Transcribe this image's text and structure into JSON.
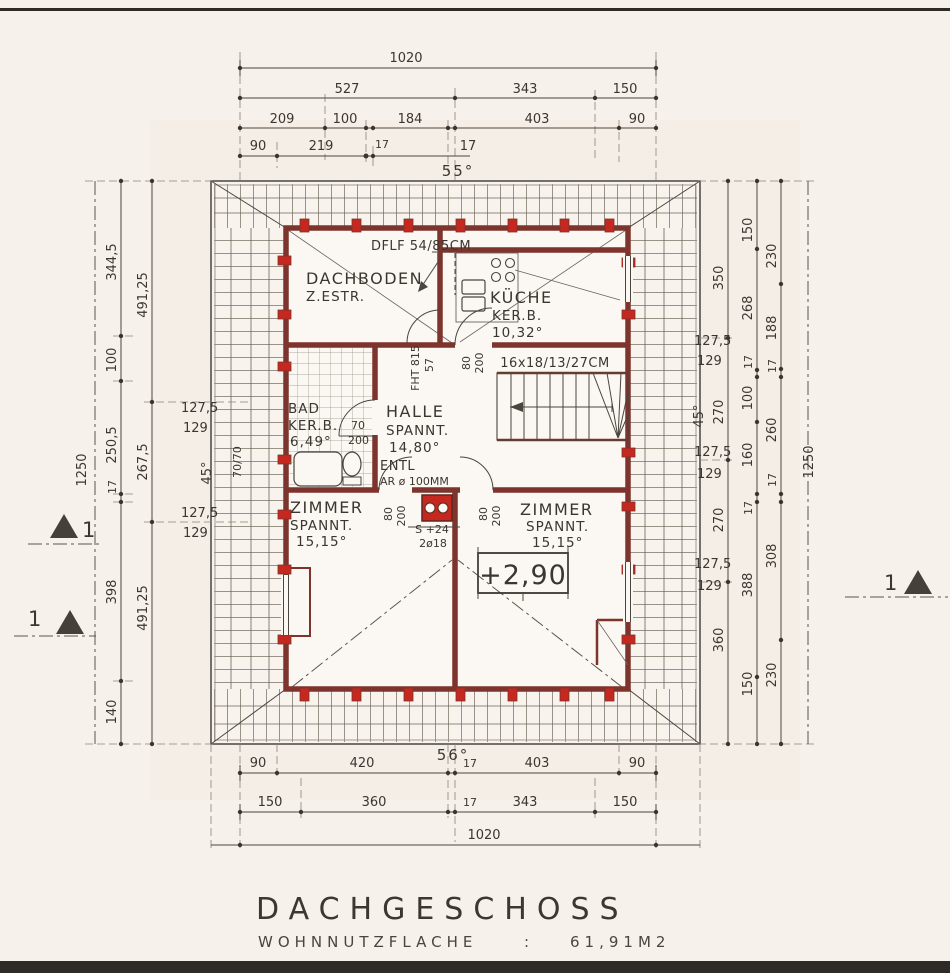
{
  "colors": {
    "paper": "#f6f1ea",
    "wall_red": "#7d342c",
    "accent_red": "#c5281f",
    "line": "#4a453e"
  },
  "title": {
    "main": "DACHGESCHOSS",
    "sub_label": "WOHNNUTZFLACHE",
    "sub_colon": ":",
    "sub_value": "61,91M2"
  },
  "rooms": {
    "dachboden": {
      "name": "DACHBODEN",
      "type": "Z.ESTR."
    },
    "kueche": {
      "name": "KÜCHE",
      "type": "KER.B.",
      "area": "10,32°"
    },
    "bad": {
      "name": "BAD",
      "type": "KER.B.",
      "area": "6,49°"
    },
    "halle": {
      "name": "HALLE",
      "type": "SPANNT.",
      "area": "14,80°"
    },
    "zimmer_links": {
      "name": "ZIMMER",
      "type": "SPANNT.",
      "area": "15,15°"
    },
    "zimmer_rechts": {
      "name": "ZIMMER",
      "type": "SPANNT.",
      "area": "15,15°"
    }
  },
  "annotations": {
    "skylight": "DFLF 54/85CM",
    "stair_note": "16x18/13/27CM",
    "vent1": "ENTL",
    "vent2": "AR ø 100MM",
    "level": "+2,90",
    "chimney1": "S +24",
    "chimney2": "2ø18",
    "fht": "FHT 815",
    "fht57": "57",
    "door_bad_w": "70",
    "door_bad_h": "200",
    "door_w": "80",
    "door_h": "200",
    "post": "70/70",
    "angle_top": "55°",
    "angle_bottom": "56°",
    "angle_left": "45°",
    "angle_right": "45°",
    "section": "1"
  },
  "dims": {
    "top": {
      "total": "1020",
      "r2": [
        "527",
        "343",
        "150"
      ],
      "r3": [
        "209",
        "100",
        "184",
        "403",
        "90"
      ],
      "r4": [
        "90",
        "219",
        "17",
        "17"
      ]
    },
    "bottom": {
      "r1": [
        "90",
        "420",
        "17",
        "403",
        "90"
      ],
      "r2": [
        "150",
        "360",
        "17",
        "343",
        "150"
      ],
      "total": "1020"
    },
    "left": {
      "total": "1250",
      "a": [
        "344,5",
        "100",
        "250,5",
        "17",
        "398",
        "140"
      ],
      "b": [
        "491,25",
        "267,5",
        "491,25"
      ],
      "k1a": "127,5",
      "k1b": "129",
      "k2a": "127,5",
      "k2b": "129"
    },
    "right": {
      "total": "1250",
      "a": [
        "350",
        "270",
        "270",
        "360"
      ],
      "b": [
        "150",
        "268",
        "17",
        "100",
        "160",
        "17",
        "388",
        "150"
      ],
      "c": [
        "230",
        "188",
        "17",
        "260",
        "17",
        "308",
        "230"
      ],
      "k1a": "127,5",
      "k1b": "129",
      "k2a": "127,5",
      "k2b": "129",
      "k3a": "127,5",
      "k3b": "129"
    }
  }
}
